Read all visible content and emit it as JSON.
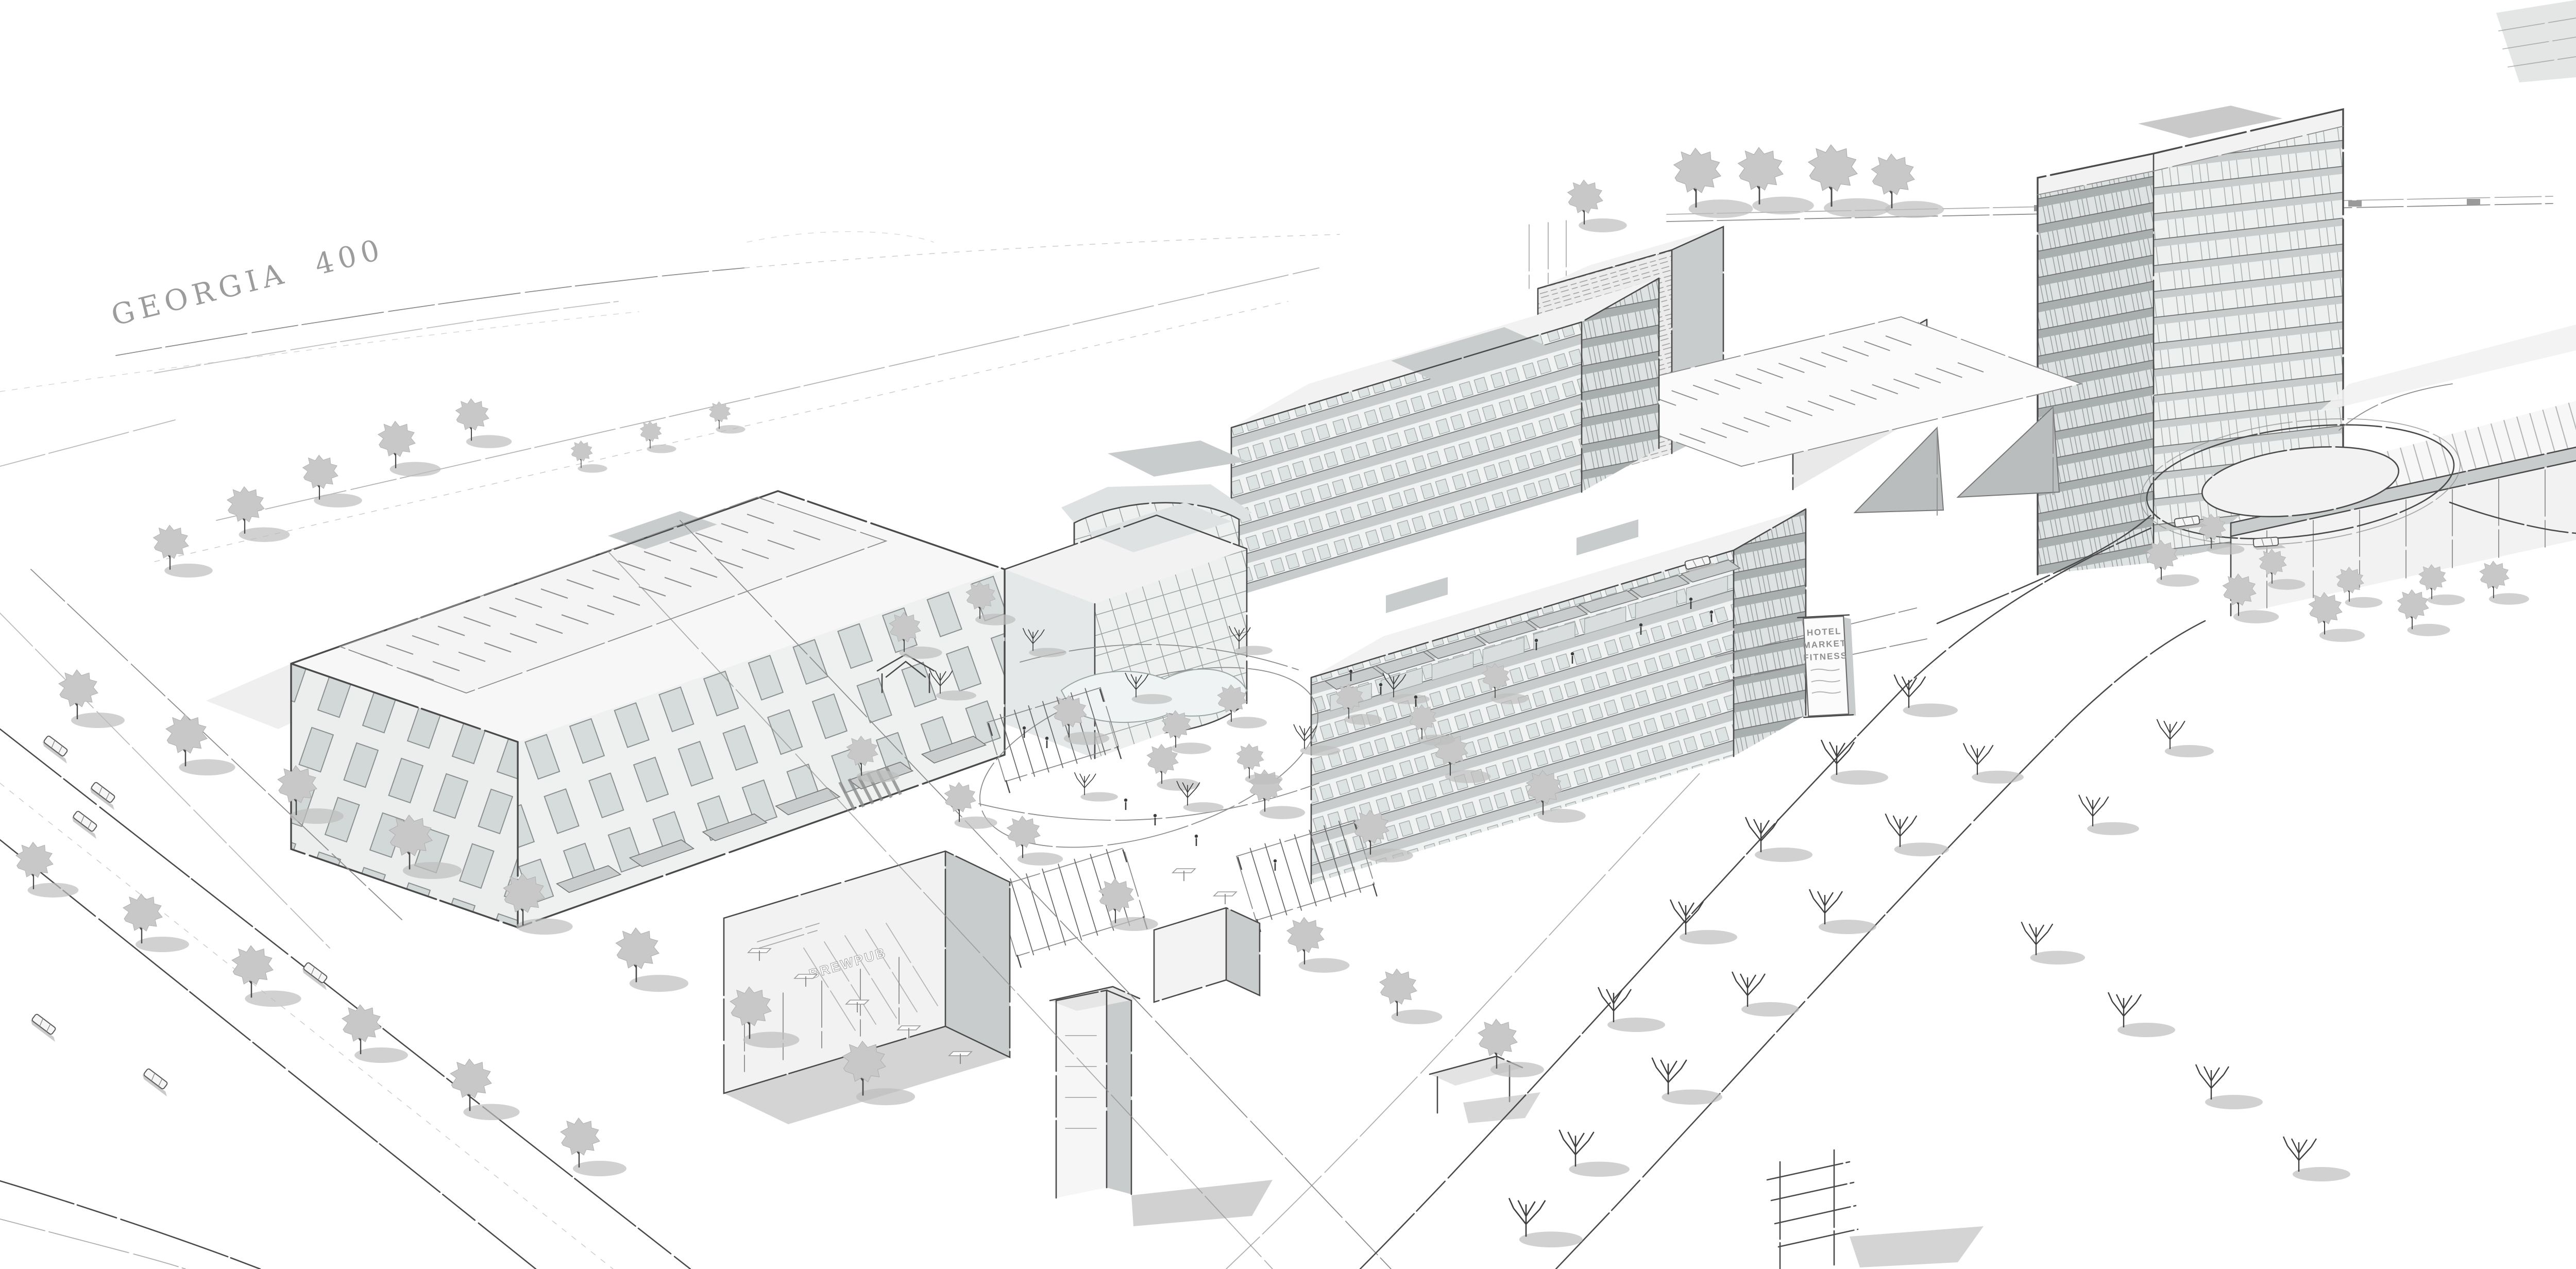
{
  "highway_label": {
    "text": "GEORGIA 400"
  },
  "monument_sign": {
    "lines": [
      "HOTEL",
      "MARKET",
      "FITNESS"
    ]
  },
  "brewpub_sign": {
    "text": "BREWPUB"
  },
  "palette": {
    "paper": "#ffffff",
    "ink": "#4a4a4a",
    "ink_light": "#8c8c8c",
    "ink_faint": "#c9c9c9",
    "shadow": "#bdbdbd",
    "canopy": "#c8c8c8",
    "facade_light": "#f2f2f2",
    "facade_mid": "#dfe2e2",
    "facade_dark": "#c9cccc",
    "glass": "#edf0ef",
    "roof": "#f7f7f7",
    "label": "#9c9c9c",
    "sign_text": "#8f8f8f"
  }
}
